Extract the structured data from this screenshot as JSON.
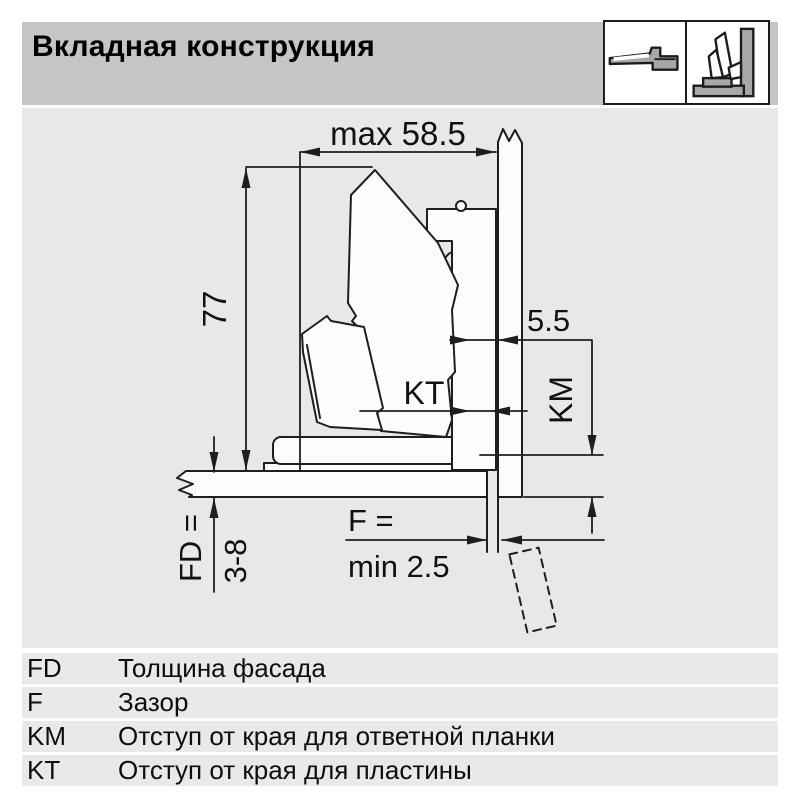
{
  "header": {
    "title": "Вкладная конструкция",
    "icons": [
      {
        "name": "hinge-straight-arm-pictogram"
      },
      {
        "name": "hinge-inset-open-pictogram"
      }
    ]
  },
  "colors": {
    "header_bg": "#c5c5c5",
    "diagram_bg": "#e8e8e6",
    "legend_row_bg": "#e9e9e8",
    "line": "#1e1e1e",
    "shape_fill": "#fcfcfb",
    "pictogram_gray": "#a8a8a8"
  },
  "diagram": {
    "labels": {
      "max_width": "max 58.5",
      "height": "77",
      "arm_clearance": "5.5",
      "kt": "KT",
      "km": "KM",
      "fd_label": "FD =",
      "fd_value": "3-8",
      "f_label": "F =",
      "f_value": "min 2.5"
    }
  },
  "legend": {
    "rows": [
      {
        "key": "FD",
        "description": "Толщина фасада"
      },
      {
        "key": "F",
        "description": "Зазор"
      },
      {
        "key": "KM",
        "description": "Отступ от края для ответной планки"
      },
      {
        "key": "KT",
        "description": "Отступ от края для пластины"
      }
    ]
  }
}
